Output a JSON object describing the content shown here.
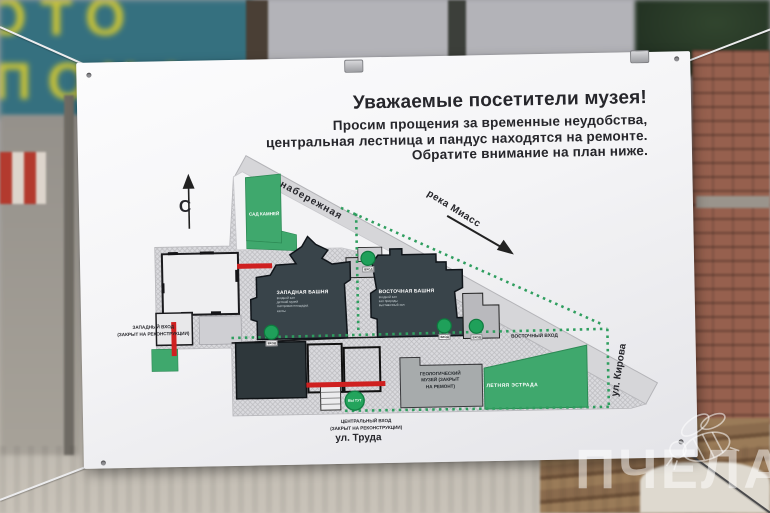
{
  "photo": {
    "sign_text_top": "ОТО",
    "sign_text_bottom": "ПОХА",
    "watermark_text": "ПЧЕЛА"
  },
  "poster": {
    "title": "Уважаемые посетители музея!",
    "subtitle_line1": "Просим прощения за временные неудобства,",
    "subtitle_line2": "центральная лестница и пандус находятся на ремонте.",
    "subtitle_line3": "Обратите внимание на план ниже."
  },
  "map": {
    "north_symbol": "С",
    "street_naberezhnaya": "набережная",
    "river_miass": "река Миасс",
    "street_kirova": "ул. Кирова",
    "street_truda": "ул. Труда",
    "rock_garden": "САД КАМНЕЙ",
    "summer_stage": "ЛЕТНЯЯ ЭСТРАДА",
    "west_tower_name": "ЗАПАДНАЯ БАШНЯ",
    "west_tower_lines": [
      "входной зал",
      "детский музей",
      "смотровая площадка",
      "кассы"
    ],
    "east_tower_name": "ВОСТОЧНАЯ БАШНЯ",
    "east_tower_lines": [
      "входной зал",
      "зал природы",
      "выставочный зал"
    ],
    "geo_museum_line1": "ГЕОЛОГИЧЕСКИЙ",
    "geo_museum_line2": "МУЗЕЙ (ЗАКРЫТ",
    "geo_museum_line3": "НА РЕМОНТ)",
    "west_entrance_line1": "ЗАПАДНЫЙ ВХОД",
    "west_entrance_line2": "(ЗАКРЫТ НА РЕКОНСТРУКЦИИ)",
    "central_entrance_line1": "ЦЕНТРАЛЬНЫЙ ВХОД",
    "central_entrance_line2": "(ЗАКРЫТ НА РЕКОНСТРУКЦИИ)",
    "east_entrance": "ВОСТОЧНЫЙ ВХОД",
    "pin_entrance": "ВХОД",
    "pin_you_are_here": "ВЫ ТУТ",
    "colors": {
      "map_green": "#3fa86d",
      "dark_building": "#39444a",
      "closed_red": "#cf2020",
      "path_green": "#2f9e5f"
    }
  }
}
